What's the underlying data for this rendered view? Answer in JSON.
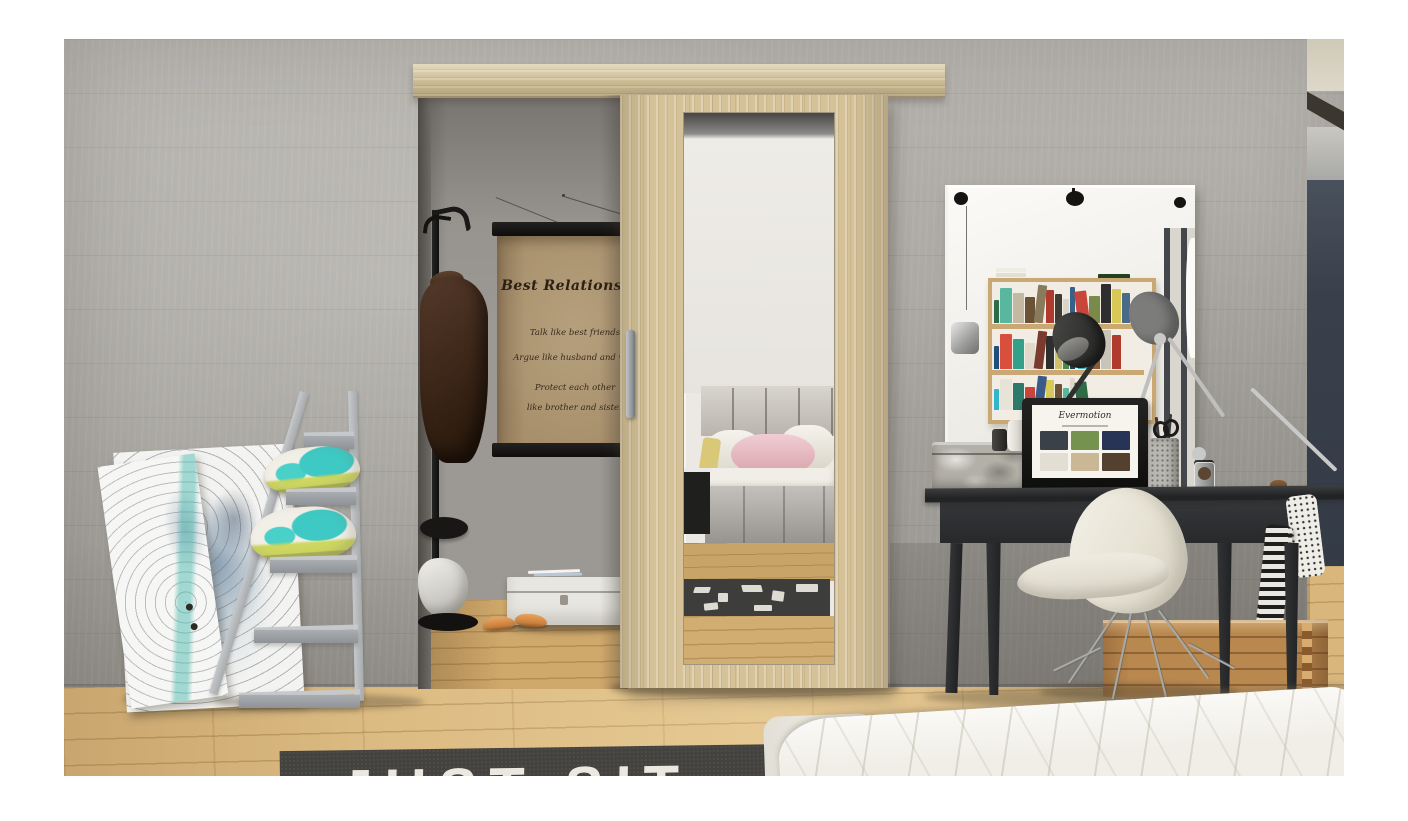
{
  "photo": {
    "poster": {
      "title": "Best Relationship",
      "lines": [
        "Talk like best friends",
        "Argue like husband and wife",
        "Protect each other",
        "like brother and sister"
      ]
    },
    "rug_text": "JUST SIT",
    "laptop": {
      "logo": "Evermotion",
      "thumb_colors": [
        "#3a4148",
        "#76924f",
        "#273455",
        "#e2ded4",
        "#c9b795",
        "#54402e"
      ]
    },
    "mirror_reflection": {
      "book_colors_row1": [
        "#2e6b46",
        "#59b7a0",
        "#c3b9a2",
        "#6b5136",
        "#8a7a5c",
        "#b03a2e",
        "#3f3a33",
        "#d9d5c9",
        "#35618a",
        "#c8453a",
        "#7a8a4a",
        "#2e2e2e",
        "#d8c858",
        "#4a6a8a"
      ],
      "book_colors_row2": [
        "#1f4f7a",
        "#d94f3d",
        "#35a08a",
        "#e0d8c8",
        "#7a3b2e",
        "#2e2e2e",
        "#cfc069",
        "#4a8a4a",
        "#263a55",
        "#35b5c8",
        "#8a5a36",
        "#c8c4b8",
        "#b03a2e"
      ],
      "book_colors_row3": [
        "#35b5c8",
        "#e8e3d8",
        "#2e7a6a",
        "#c8453a",
        "#3a5a8a",
        "#d8c858",
        "#6b5136",
        "#59b7a0",
        "#e0d8c8",
        "#2e6b46"
      ]
    },
    "palette": {
      "concrete_wall": "#adaaa4",
      "oak_wood": "#d6c298",
      "floor_oak": "#dcbb82",
      "alcove_wall": "#9c9894",
      "navy_wall": "#3a424e",
      "rug_dark": "#43423e",
      "desk_black": "#2b2c2e",
      "ladder_gray": "#b3b6b9",
      "pillow_teal": "#3fc9c4",
      "pillow_yellow": "#cdd65a",
      "reflected_pink_pillow": "#e4b6bd",
      "crate_wood": "#b9884f",
      "bed_white": "#f0eee6",
      "poster_paper": "#a8906c",
      "chair_white": "#ece8dd"
    }
  }
}
